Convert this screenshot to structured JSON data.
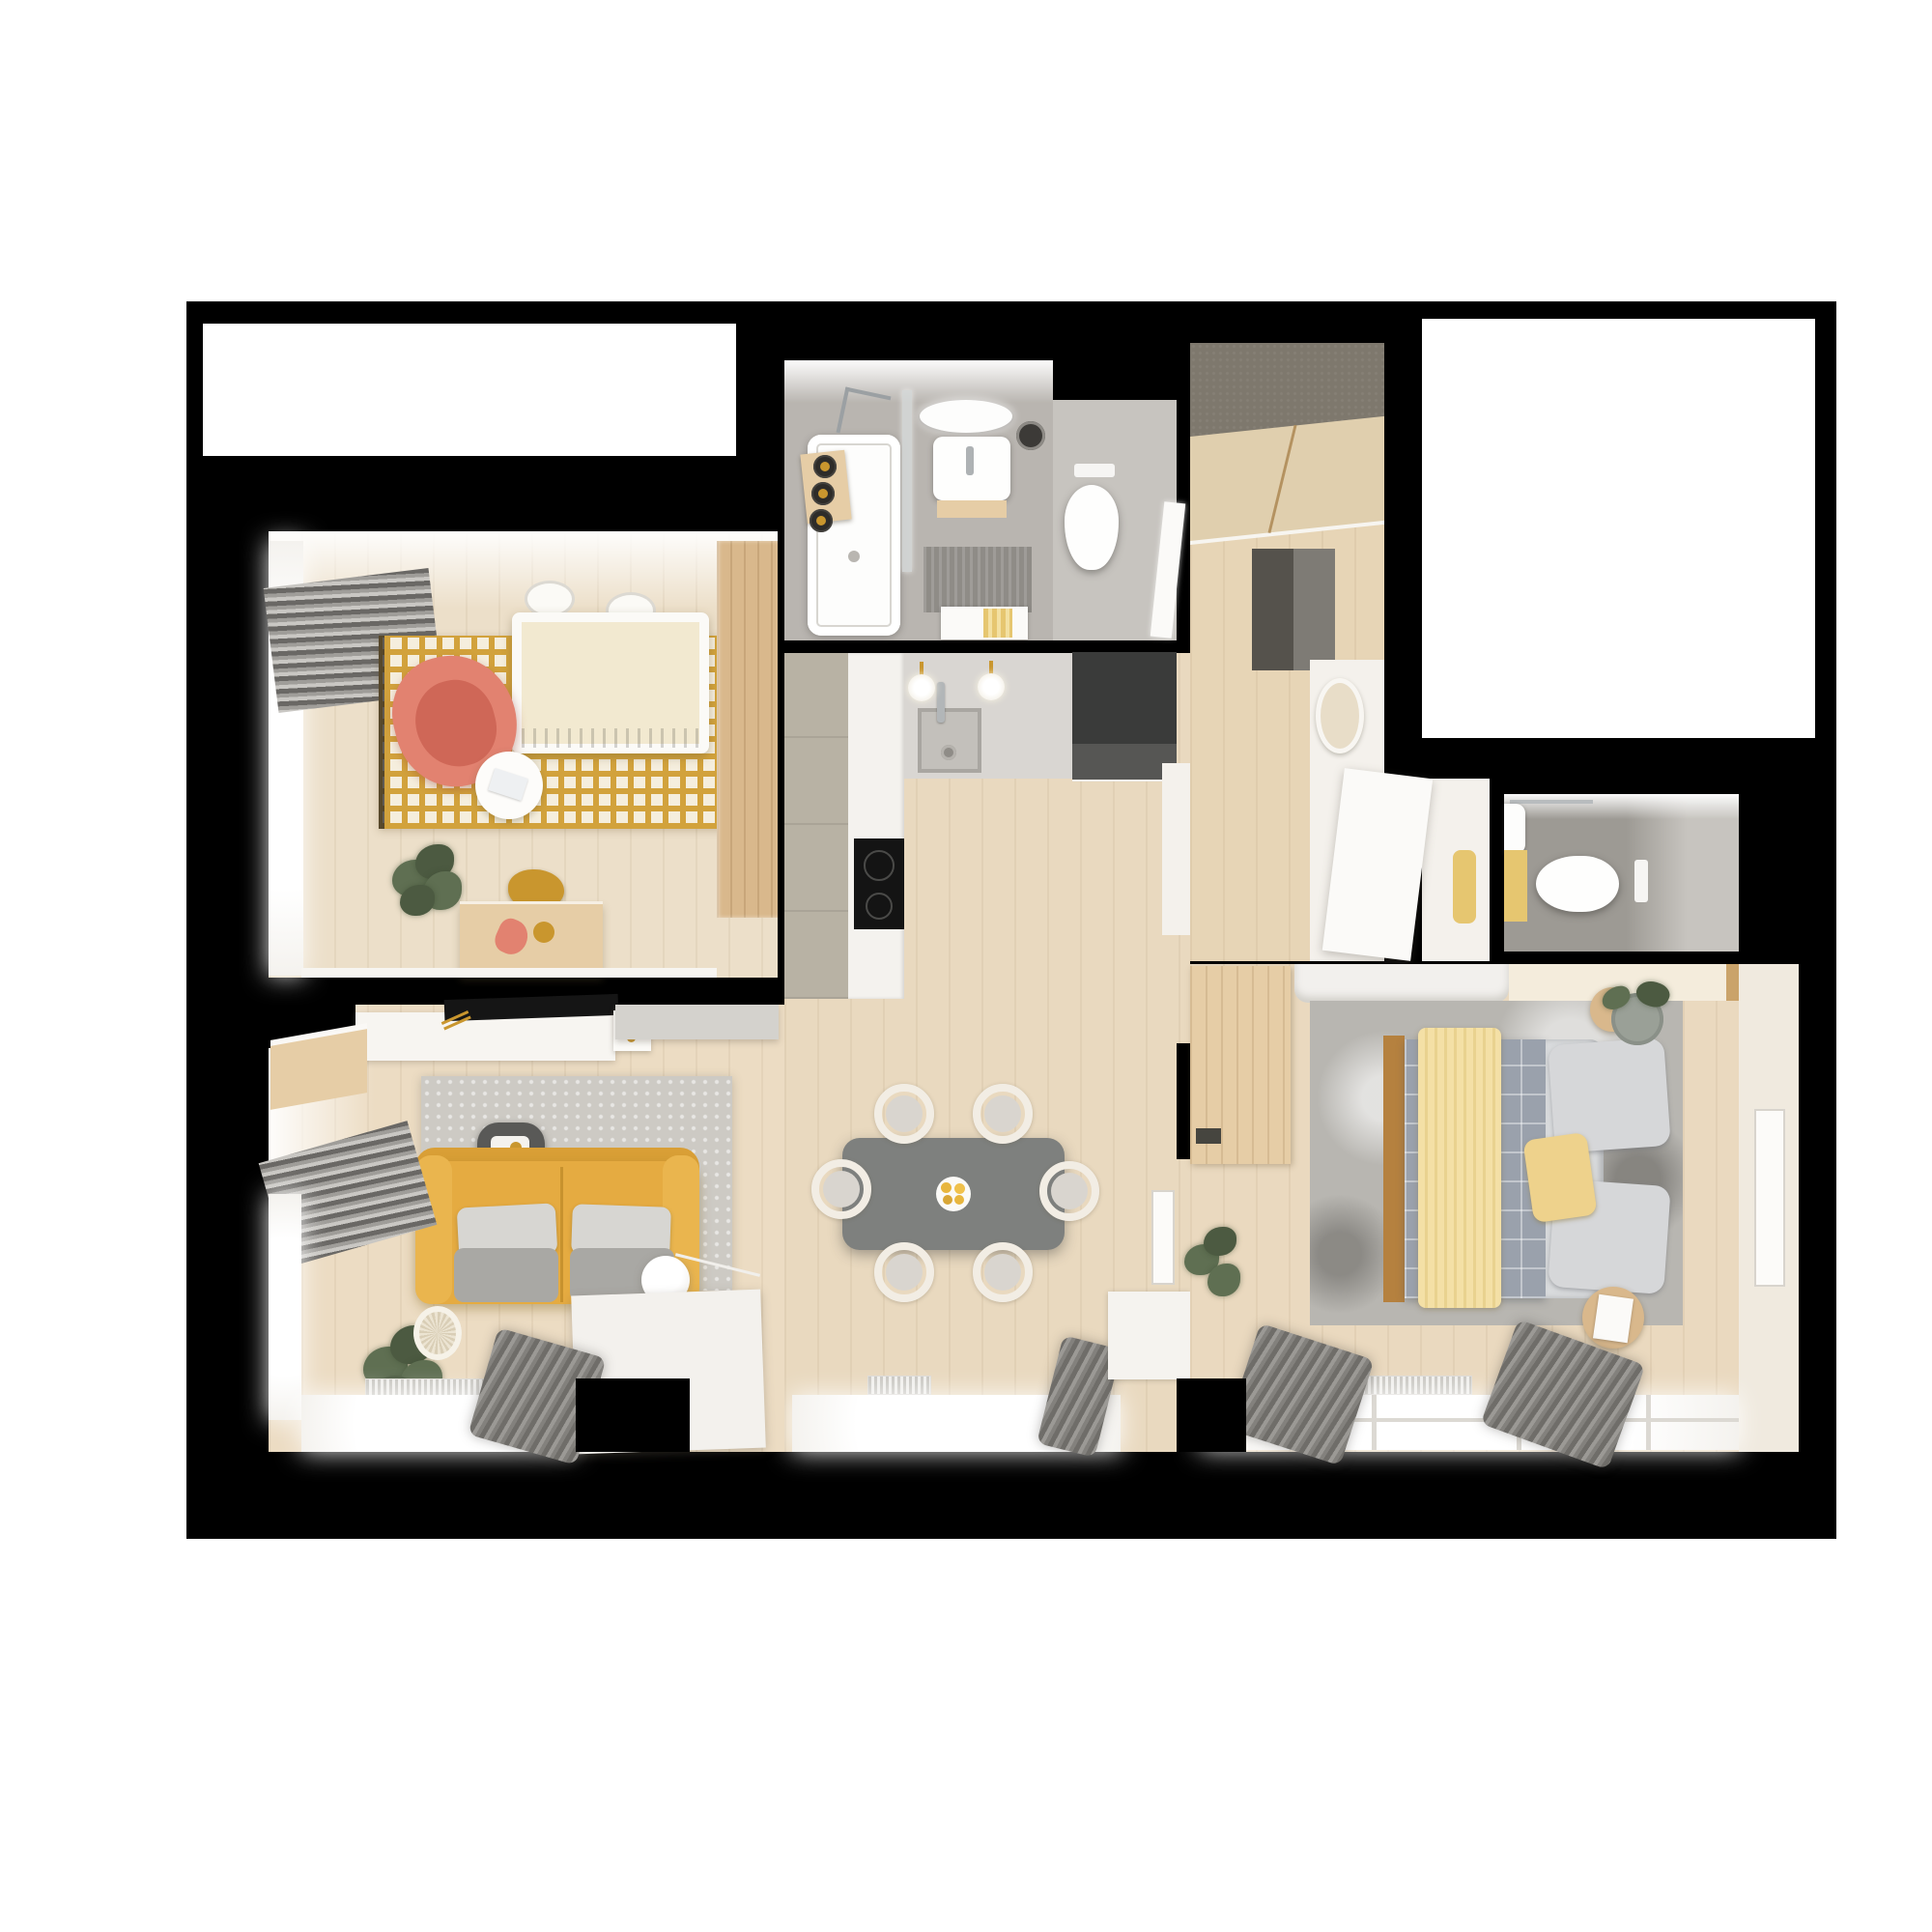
{
  "scene": {
    "description": "3D rendered top-down floor plan of a furnished one-bedroom apartment on a white page with black cut walls",
    "background": "#ffffff"
  },
  "colors": {
    "frame": "#000000",
    "wallWhite": "#f6f3ee",
    "floorNursery": "#ecdfc9",
    "floorLiving": "#ecdcc3",
    "floorKitchen": "#e9d9bf",
    "floorHallway": "#e7d5b6",
    "floorBedroom": "#ead9bf",
    "floorBathroom": "#b9b5b0",
    "floorWcDark": "#9d9a94",
    "floorWcLight": "#c7c4bf",
    "rugNurseryBase": "#f5eedd",
    "rugNurseryPattern": "#d2a23c",
    "rugLiving": "#cdcac4",
    "rugBedroom": "#b8b6b1",
    "sofaYellow": "#e5ab41",
    "sofaYellowDark": "#d99f36",
    "sofaYellowLight": "#eab54e",
    "cushionLight": "#d7d6d2",
    "cushionGray": "#a9a8a4",
    "coral": "#e28270",
    "coralDark": "#cf6757",
    "cribMattress": "#f2e9d0",
    "tableGray": "#7e807e",
    "chairWhite": "#f2ede4",
    "chairSeat": "#d9d5cf",
    "fruitYellow": "#e8b63e",
    "darkUnit": "#3a3b3a",
    "darkUnitFront": "#565654",
    "cabinetGray": "#b8b2a4",
    "counterWhite": "#f4f2ee",
    "backsplash": "#d9d6d2",
    "sinkGray": "#c3c0bb",
    "cooktop": "#141414",
    "gold": "#c9962e",
    "wardrobeTop": "#7e786d",
    "wardrobeDoor": "#e0cfae",
    "doormatDark": "#55524c",
    "doormatLight": "#7e7b75",
    "matYellow": "#e6c670",
    "matBath": "#8f8c87",
    "throwYellow": "#f4e0a6",
    "throwStripe": "#e9d28f",
    "pillowYellow": "#eed28c",
    "plaid": "#9aa1ac",
    "plaidLine": "#c5cad1",
    "duvet": "#d9dbdd",
    "pillowGray": "#d6d7d9",
    "curtain1": "#6f6d69",
    "curtain2": "#9b9995",
    "curtain3": "#83817d",
    "woodLight": "#e6cda6",
    "woodMid": "#d9b88c",
    "woodDark": "#caa36a",
    "woodFrame": "#b5813f",
    "plantGreen": "#5f6f52",
    "plantGreenDark": "#4c5a41",
    "basket": "#ece4d2",
    "benchWhite": "#f2f0ed",
    "creamCabinet": "#f4ecdc",
    "sideTableDark": "#595957",
    "artWhite": "#fcfbf9",
    "glass": "#d7dbdb"
  },
  "rooms": [
    {
      "id": "nursery",
      "label": "Nursery with crib, coral armchair and yellow patterned rug"
    },
    {
      "id": "bathroom",
      "label": "Bathroom with bathtub, washbasin, mirror and toilet"
    },
    {
      "id": "kitchen",
      "label": "Kitchen with counters, sink, cooktop and dark tall unit"
    },
    {
      "id": "dining",
      "label": "Open dining area with gray table and six chairs"
    },
    {
      "id": "hallway",
      "label": "Entry hallway with wardrobe and doormat"
    },
    {
      "id": "nook",
      "label": "Desk nook with writing desk and chair"
    },
    {
      "id": "wc",
      "label": "Guest WC with wall-hung toilet"
    },
    {
      "id": "living",
      "label": "Living room with yellow sofa, rug and media wall"
    },
    {
      "id": "bedroom",
      "label": "Bedroom with double bed, rug and wardrobe bench"
    }
  ],
  "furniture": {
    "crib": "White crib with patterned mattress",
    "armchair": "Coral nursing armchair",
    "nurseryRug": "Yellow geometric rug",
    "dresser": "Wooden toy dresser",
    "bathtub": "White bathtub with shower glass",
    "washbasin": "Washbasin with oval mirror",
    "toilet": "Toilet",
    "kitchenSink": "Undermount kitchen sink",
    "cooktop": "Black induction cooktop",
    "fridge": "Dark tall kitchen unit",
    "diningTable": "Gray dining table",
    "diningChair": "White horseshoe chair",
    "fruitPlate": "Plate with yellow fruit",
    "wardrobe": "Hallway wardrobe with sliding doors",
    "doormat": "Two-tone doormat",
    "desk": "White writing desk",
    "wcToilet": "Guest toilet",
    "sofa": "Yellow two-seat sofa with gray cushions",
    "mediaConsole": "White media console",
    "tv": "Flat TV panel",
    "floorLamp": "White globe floor lamp",
    "sideboard": "White sideboard",
    "bed": "Double bed with plaid blanket, yellow throw and pillows",
    "bedBench": "Bedroom bench and cream cabinet",
    "bedroomDesk": "Wooden bedroom desk",
    "nightstand": "Round nightstand with plant",
    "artFrame": "Framed artwork",
    "plant": "Potted green plant"
  }
}
